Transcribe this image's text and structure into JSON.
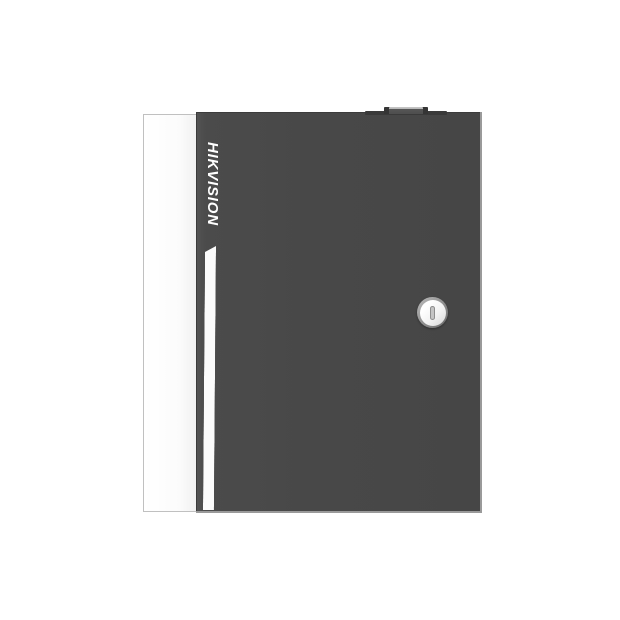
{
  "product": {
    "brand_label": "HIKVISION",
    "description": "Dark grey wall-mount access controller cabinet with white side panel, vertical brand wordmark, white accent stripe, top latch block and circular cam lock with vertical keyhole"
  },
  "colors": {
    "background": "#ffffff",
    "door_grey": "#484848",
    "door_bevel": "#9a9a9a",
    "side_panel_white": "#fcfcfc",
    "accent_stripe_white": "#fbfbfb",
    "brand_text": "#ffffff",
    "latch_dark": "#3a3a3a",
    "latch_highlight": "#c9c9c9",
    "lock_ring": "#8d8d8d",
    "lock_face": "#ffffff",
    "keyhole_grey": "#c4c4c4"
  }
}
